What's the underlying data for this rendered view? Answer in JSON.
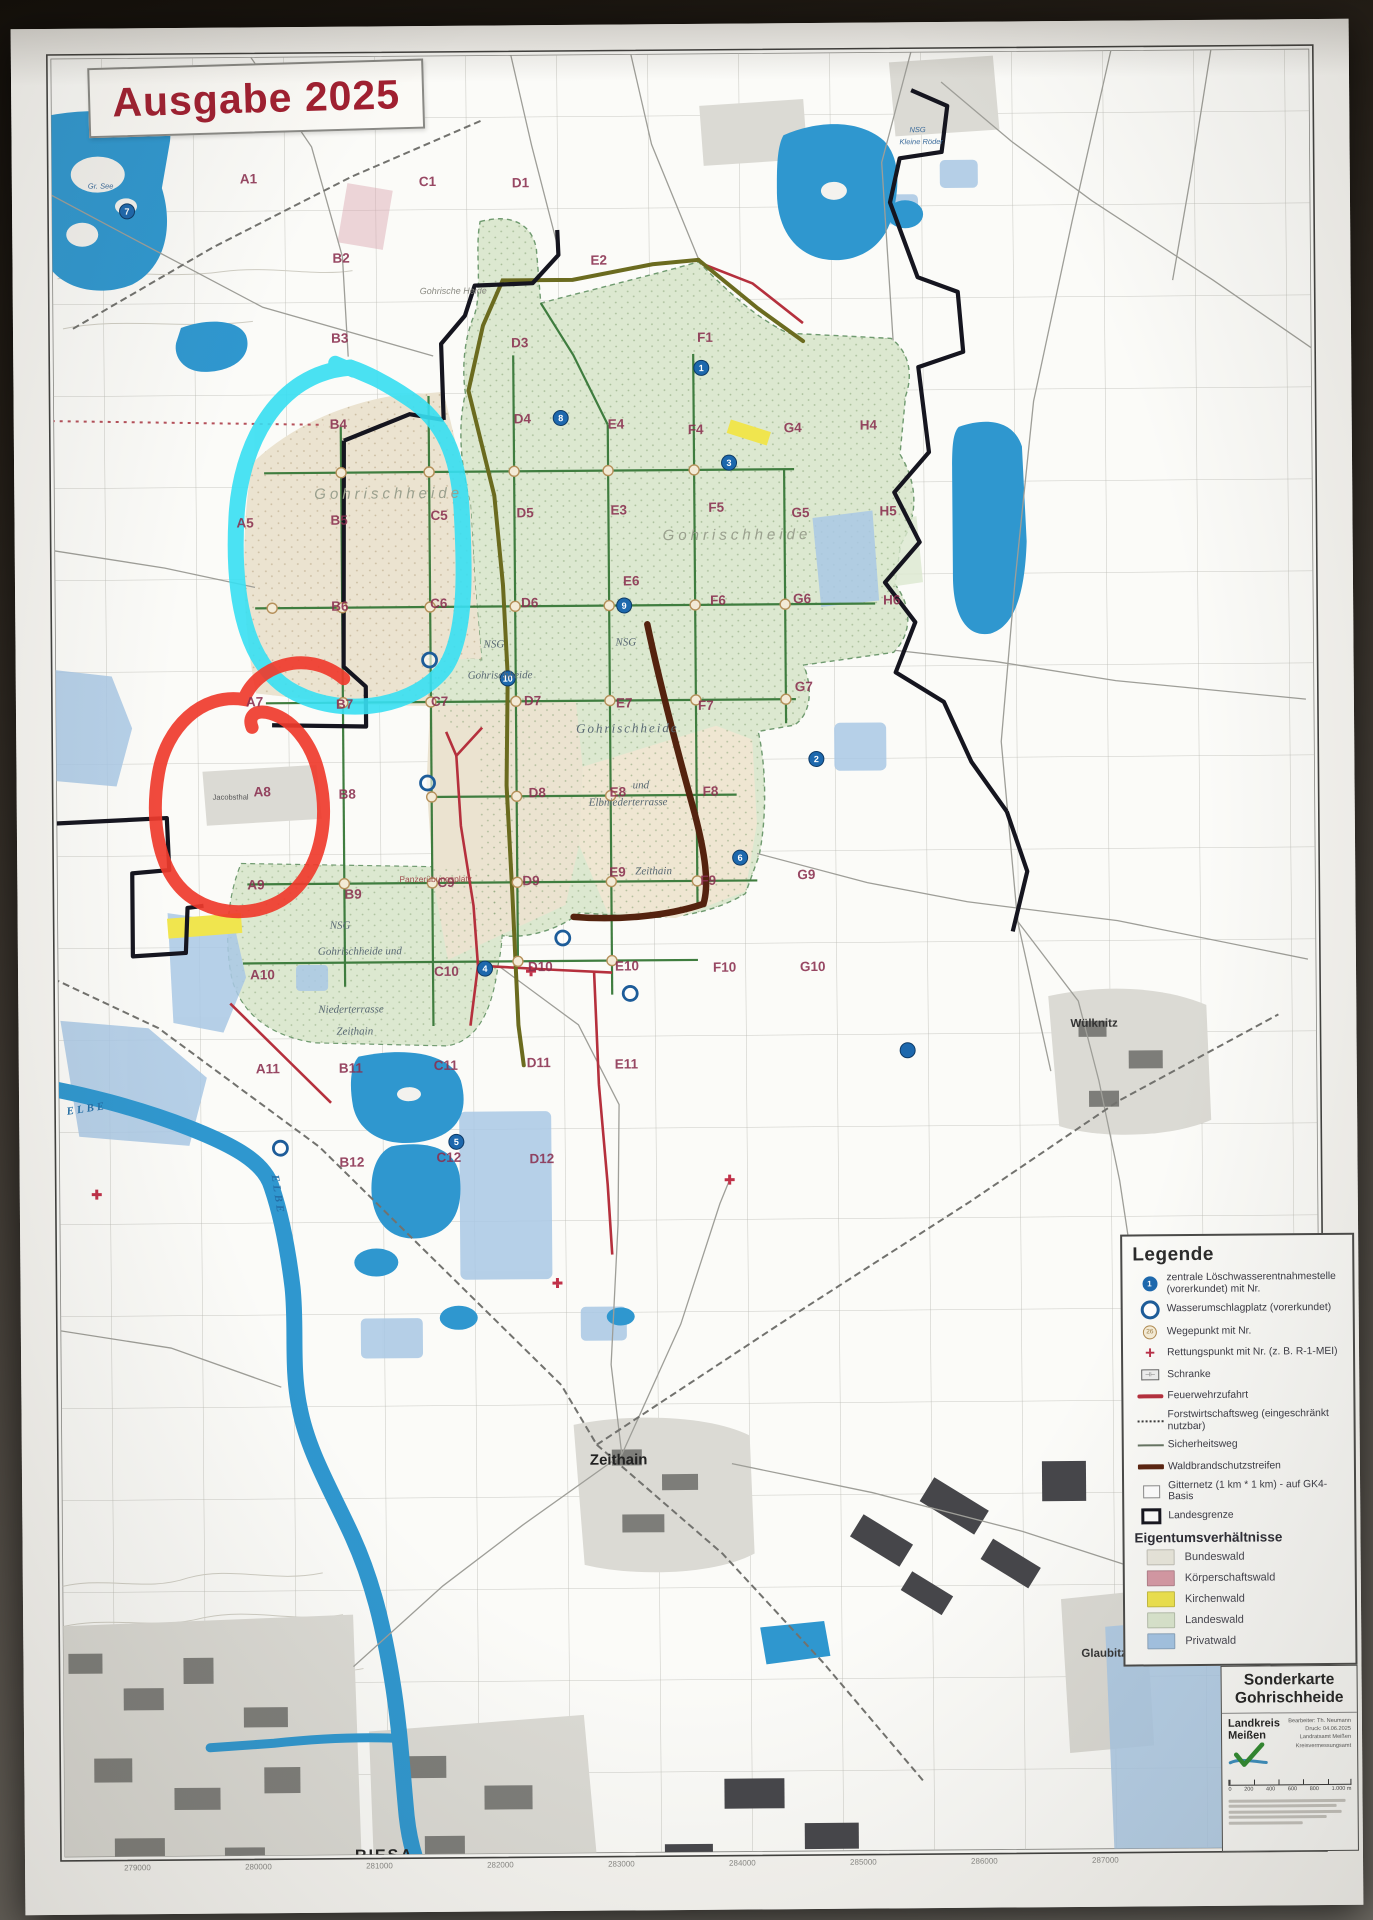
{
  "edition_badge": {
    "text": "Ausgabe 2025",
    "color": "#a01f30"
  },
  "map": {
    "grid_labels": [
      {
        "t": "A1",
        "x": 228,
        "y": 156
      },
      {
        "t": "C1",
        "x": 407,
        "y": 160
      },
      {
        "t": "D1",
        "x": 500,
        "y": 162
      },
      {
        "t": "B2",
        "x": 320,
        "y": 236
      },
      {
        "t": "E2",
        "x": 578,
        "y": 240
      },
      {
        "t": "B3",
        "x": 318,
        "y": 316
      },
      {
        "t": "D3",
        "x": 498,
        "y": 322
      },
      {
        "t": "F1",
        "x": 684,
        "y": 318
      },
      {
        "t": "B4",
        "x": 316,
        "y": 402
      },
      {
        "t": "D4",
        "x": 500,
        "y": 398
      },
      {
        "t": "E4",
        "x": 594,
        "y": 404
      },
      {
        "t": "F4",
        "x": 674,
        "y": 410
      },
      {
        "t": "G4",
        "x": 770,
        "y": 409
      },
      {
        "t": "H4",
        "x": 846,
        "y": 407
      },
      {
        "t": "A5",
        "x": 222,
        "y": 500
      },
      {
        "t": "B5",
        "x": 316,
        "y": 498
      },
      {
        "t": "C5",
        "x": 416,
        "y": 494
      },
      {
        "t": "D5",
        "x": 502,
        "y": 492
      },
      {
        "t": "E3",
        "x": 596,
        "y": 490
      },
      {
        "t": "F5",
        "x": 694,
        "y": 488
      },
      {
        "t": "G5",
        "x": 777,
        "y": 494
      },
      {
        "t": "H5",
        "x": 865,
        "y": 493
      },
      {
        "t": "B6",
        "x": 316,
        "y": 584
      },
      {
        "t": "C6",
        "x": 415,
        "y": 582
      },
      {
        "t": "D6",
        "x": 506,
        "y": 582
      },
      {
        "t": "E6",
        "x": 608,
        "y": 561
      },
      {
        "t": "F6",
        "x": 695,
        "y": 581
      },
      {
        "t": "G6",
        "x": 778,
        "y": 580
      },
      {
        "t": "H6",
        "x": 868,
        "y": 582
      },
      {
        "t": "A7",
        "x": 230,
        "y": 679
      },
      {
        "t": "B7",
        "x": 320,
        "y": 682
      },
      {
        "t": "C7",
        "x": 415,
        "y": 680
      },
      {
        "t": "D7",
        "x": 508,
        "y": 680
      },
      {
        "t": "E7",
        "x": 600,
        "y": 683
      },
      {
        "t": "F7",
        "x": 682,
        "y": 686
      },
      {
        "t": "G7",
        "x": 779,
        "y": 668
      },
      {
        "t": "A8",
        "x": 237,
        "y": 769
      },
      {
        "t": "B8",
        "x": 322,
        "y": 772
      },
      {
        "t": "D8",
        "x": 512,
        "y": 772
      },
      {
        "t": "E8",
        "x": 593,
        "y": 772
      },
      {
        "t": "F8",
        "x": 686,
        "y": 772
      },
      {
        "t": "A9",
        "x": 230,
        "y": 862
      },
      {
        "t": "B9",
        "x": 327,
        "y": 872
      },
      {
        "t": "C9",
        "x": 420,
        "y": 861
      },
      {
        "t": "D9",
        "x": 505,
        "y": 860
      },
      {
        "t": "E9",
        "x": 592,
        "y": 852
      },
      {
        "t": "F9",
        "x": 683,
        "y": 861
      },
      {
        "t": "G9",
        "x": 780,
        "y": 856
      },
      {
        "t": "A10",
        "x": 232,
        "y": 952
      },
      {
        "t": "C10",
        "x": 416,
        "y": 950
      },
      {
        "t": "D10",
        "x": 510,
        "y": 946
      },
      {
        "t": "E10",
        "x": 597,
        "y": 946
      },
      {
        "t": "F10",
        "x": 695,
        "y": 948
      },
      {
        "t": "G10",
        "x": 782,
        "y": 948
      },
      {
        "t": "A11",
        "x": 237,
        "y": 1046
      },
      {
        "t": "B11",
        "x": 320,
        "y": 1046
      },
      {
        "t": "C11",
        "x": 415,
        "y": 1044
      },
      {
        "t": "D11",
        "x": 508,
        "y": 1042
      },
      {
        "t": "E11",
        "x": 596,
        "y": 1044
      },
      {
        "t": "B12",
        "x": 320,
        "y": 1140
      },
      {
        "t": "C12",
        "x": 417,
        "y": 1136
      },
      {
        "t": "D12",
        "x": 510,
        "y": 1138
      }
    ],
    "place_labels": [
      {
        "t": "Gohrische Heide",
        "x": 407,
        "y": 268,
        "cls": "pl-tiny"
      },
      {
        "t": "Gohrischheide",
        "x": 300,
        "y": 472,
        "cls": "pl-area"
      },
      {
        "t": "Gohrischheide",
        "x": 648,
        "y": 516,
        "cls": "pl-area"
      },
      {
        "t": "NSG",
        "x": 468,
        "y": 622,
        "cls": "pl-nsg"
      },
      {
        "t": "NSG",
        "x": 600,
        "y": 621,
        "cls": "pl-nsg"
      },
      {
        "t": "Gohrischheide",
        "x": 452,
        "y": 653,
        "cls": "pl-nsg"
      },
      {
        "t": "Gohrischheide",
        "x": 560,
        "y": 708,
        "cls": "pl-nsg-lg"
      },
      {
        "t": "und",
        "x": 616,
        "y": 764,
        "cls": "pl-nsg"
      },
      {
        "t": "Elbniederterrasse",
        "x": 572,
        "y": 781,
        "cls": "pl-nsg"
      },
      {
        "t": "Zeithain",
        "x": 618,
        "y": 850,
        "cls": "pl-nsg"
      },
      {
        "t": "NSG",
        "x": 312,
        "y": 902,
        "cls": "pl-nsg"
      },
      {
        "t": "Gohrischheide und",
        "x": 300,
        "y": 928,
        "cls": "pl-nsg"
      },
      {
        "t": "Niederterrasse",
        "x": 300,
        "y": 986,
        "cls": "pl-nsg"
      },
      {
        "t": "Zeithain",
        "x": 318,
        "y": 1008,
        "cls": "pl-nsg"
      },
      {
        "t": "Panzerübungsplatz",
        "x": 382,
        "y": 856,
        "cls": "pl-red"
      },
      {
        "t": "Zeithain",
        "x": 568,
        "y": 1440,
        "cls": "pl-town"
      },
      {
        "t": "Wülknitz",
        "x": 1052,
        "y": 1006,
        "cls": "pl-town-sm"
      },
      {
        "t": "Glaubitz",
        "x": 1058,
        "y": 1636,
        "cls": "pl-town-sm"
      },
      {
        "t": "RIESA",
        "x": 330,
        "y": 1834,
        "cls": "pl-city"
      },
      {
        "t": "ELBE",
        "x": 48,
        "y": 1086,
        "cls": "pl-water",
        "rot": -8
      },
      {
        "t": "ELBE",
        "x": 252,
        "y": 1148,
        "cls": "pl-water",
        "rot": 82
      },
      {
        "t": "Jacobsthal",
        "x": 196,
        "y": 772,
        "cls": "pl-micro"
      },
      {
        "t": "NSG",
        "x": 898,
        "y": 110,
        "cls": "pl-micro-b"
      },
      {
        "t": "Kleine Röder",
        "x": 888,
        "y": 122,
        "cls": "pl-micro-b"
      },
      {
        "t": "Gr. See",
        "x": 76,
        "y": 160,
        "cls": "pl-micro-b"
      }
    ],
    "blue_markers": [
      {
        "n": "7",
        "x": 115,
        "y": 183
      },
      {
        "n": "1",
        "x": 688,
        "y": 344
      },
      {
        "n": "8",
        "x": 547,
        "y": 393
      },
      {
        "n": "3",
        "x": 715,
        "y": 439
      },
      {
        "n": "9",
        "x": 609,
        "y": 581
      },
      {
        "n": "10",
        "x": 492,
        "y": 653
      },
      {
        "n": "2",
        "x": 800,
        "y": 736
      },
      {
        "n": "6",
        "x": 723,
        "y": 834
      },
      {
        "n": "4",
        "x": 467,
        "y": 943
      },
      {
        "n": "5",
        "x": 437,
        "y": 1116
      },
      {
        "n": "",
        "x": 889,
        "y": 1028
      }
    ],
    "ring_markers": [
      {
        "x": 414,
        "y": 634
      },
      {
        "x": 411,
        "y": 757
      },
      {
        "x": 545,
        "y": 913
      },
      {
        "x": 612,
        "y": 969
      },
      {
        "x": 261,
        "y": 1121
      }
    ],
    "rescue_points": [
      {
        "x": 513,
        "y": 946
      },
      {
        "x": 710,
        "y": 1156
      },
      {
        "x": 537,
        "y": 1258
      },
      {
        "x": 77,
        "y": 1166
      }
    ],
    "waypoints": [
      [
        327,
        446
      ],
      [
        415,
        446
      ],
      [
        500,
        446
      ],
      [
        594,
        446
      ],
      [
        680,
        446
      ],
      [
        257,
        581
      ],
      [
        327,
        581
      ],
      [
        415,
        581
      ],
      [
        500,
        581
      ],
      [
        594,
        581
      ],
      [
        680,
        581
      ],
      [
        770,
        581
      ],
      [
        327,
        676
      ],
      [
        415,
        676
      ],
      [
        500,
        676
      ],
      [
        594,
        676
      ],
      [
        680,
        676
      ],
      [
        770,
        676
      ],
      [
        415,
        771
      ],
      [
        500,
        771
      ],
      [
        594,
        771
      ],
      [
        327,
        857
      ],
      [
        415,
        857
      ],
      [
        500,
        857
      ],
      [
        594,
        857
      ],
      [
        680,
        857
      ],
      [
        500,
        936
      ],
      [
        594,
        936
      ]
    ],
    "bottom_coords": [
      {
        "t": "279000",
        "x": 99
      },
      {
        "t": "280000",
        "x": 220
      },
      {
        "t": "281000",
        "x": 341
      },
      {
        "t": "282000",
        "x": 462
      },
      {
        "t": "283000",
        "x": 583
      },
      {
        "t": "284000",
        "x": 704
      },
      {
        "t": "285000",
        "x": 825
      },
      {
        "t": "286000",
        "x": 946
      },
      {
        "t": "287000",
        "x": 1067
      }
    ]
  },
  "legend": {
    "title": "Legende",
    "items": [
      {
        "icon": "bluedot",
        "num": "1",
        "label": "zentrale Löschwasserentnahmestelle (vorerkundet) mit Nr."
      },
      {
        "icon": "bluering",
        "label": "Wasserumschlagplatz (vorerkundet)"
      },
      {
        "icon": "way",
        "num": "26",
        "label": "Wegepunkt mit Nr."
      },
      {
        "icon": "cross",
        "label": "Rettungspunkt mit Nr. (z. B. R-1-MEI)"
      },
      {
        "icon": "schranke",
        "label": "Schranke"
      },
      {
        "icon": "line-red",
        "label": "Feuerwehrzufahrt"
      },
      {
        "icon": "line-dot",
        "label": "Forstwirtschaftsweg (eingeschränkt nutzbar)"
      },
      {
        "icon": "line-gray",
        "label": "Sicherheitsweg"
      },
      {
        "icon": "line-brown",
        "label": "Waldbrandschutzstreifen"
      },
      {
        "icon": "sq-thin",
        "label": "Gitternetz (1 km * 1 km) - auf GK4-Basis"
      },
      {
        "icon": "sq-thick",
        "label": "Landesgrenze"
      }
    ],
    "ownership_title": "Eigentumsverhältnisse",
    "ownership": [
      {
        "color": "#eae8dd",
        "label": "Bundeswald"
      },
      {
        "color": "#d79aa6",
        "label": "Körperschaftswald"
      },
      {
        "color": "#f0e54e",
        "label": "Kirchenwald"
      },
      {
        "color": "#dce8d0",
        "label": "Landeswald"
      },
      {
        "color": "#a5c6e6",
        "label": "Privatwald"
      }
    ]
  },
  "title_block": {
    "title_line1": "Sonderkarte",
    "title_line2": "Gohrischheide",
    "agency_line1": "Landkreis",
    "agency_line2": "Meißen",
    "credits": [
      "Bearbeiter: Th. Neumann",
      "Druck: 04.06.2025",
      "Landratsamt Meißen",
      "Kreisvermessungsamt"
    ],
    "scale_labels": [
      "0",
      "200",
      "400",
      "600",
      "800",
      "1.000 m"
    ]
  }
}
